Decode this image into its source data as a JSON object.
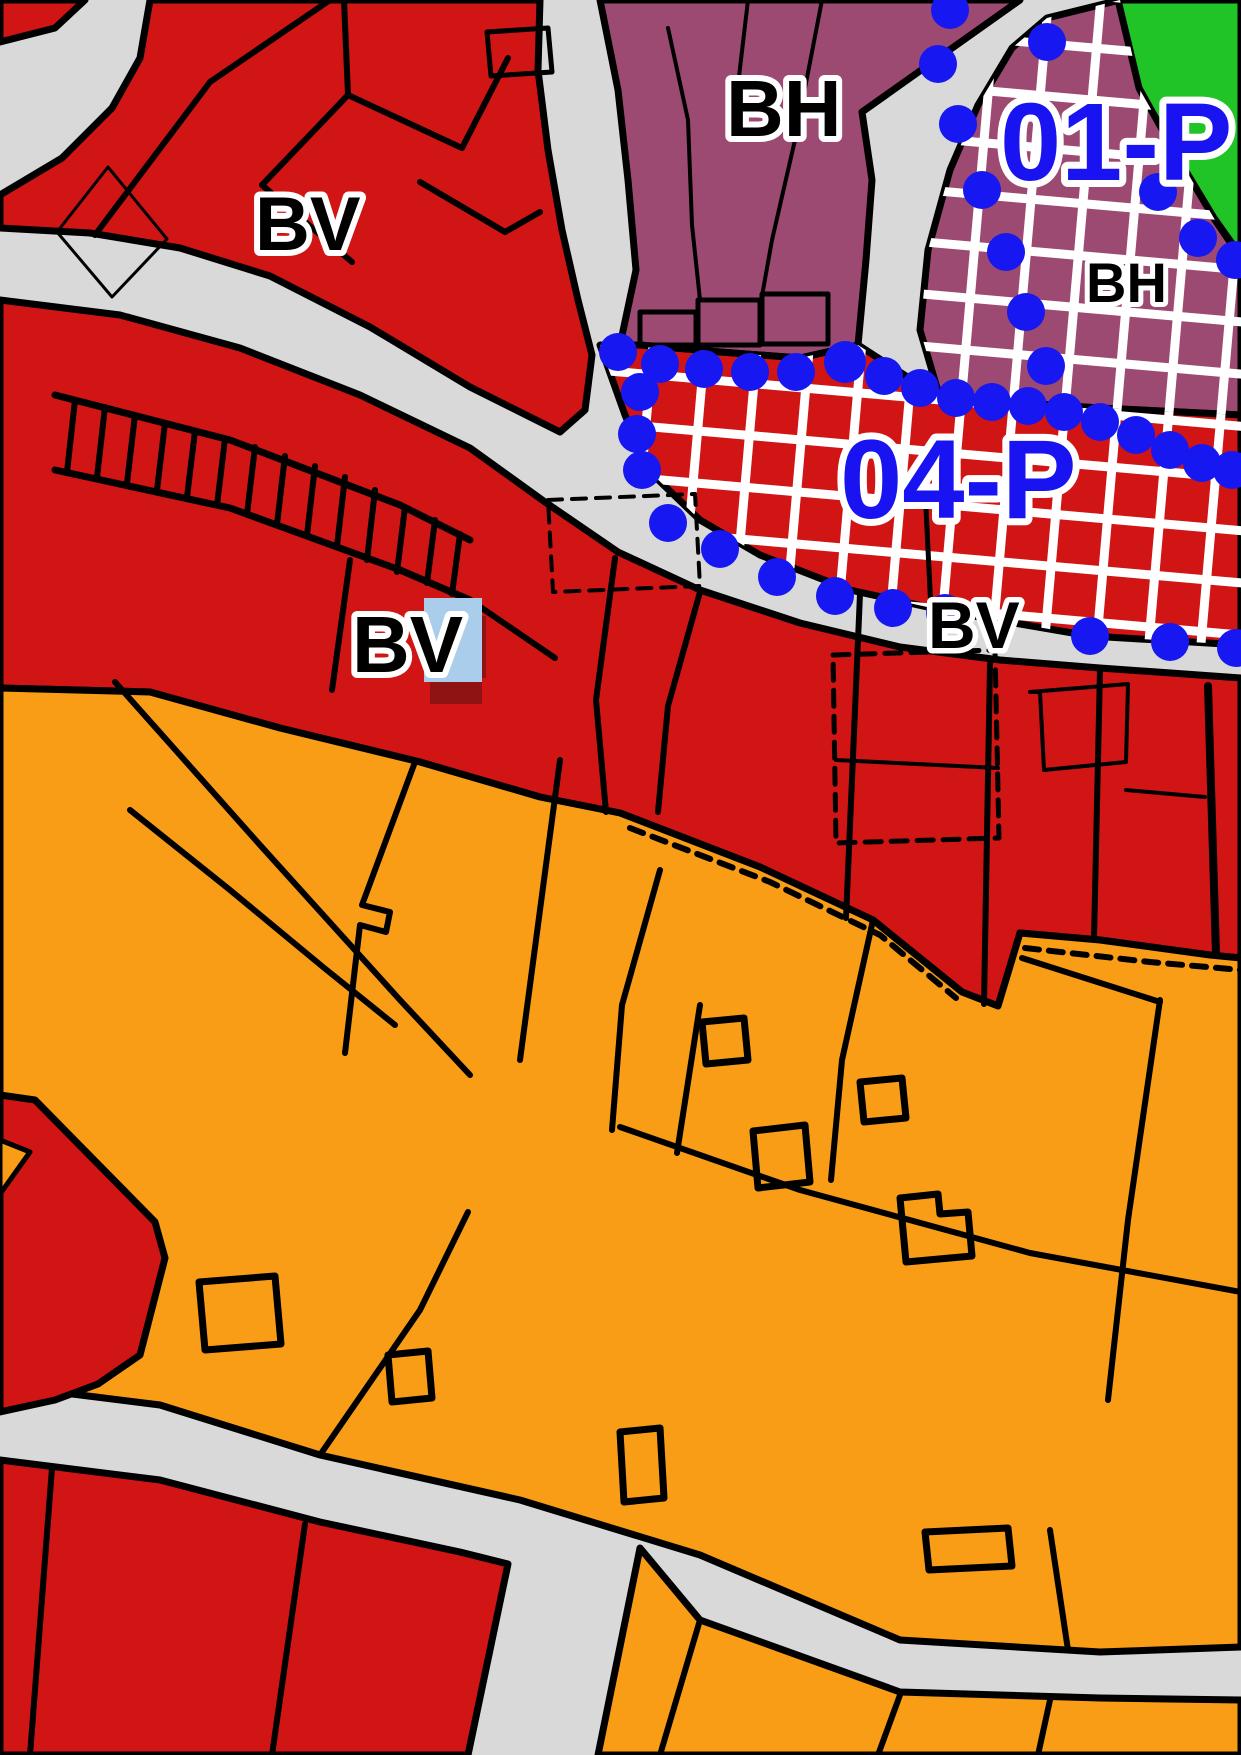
{
  "map": {
    "type": "zoning-plan-map",
    "labels": {
      "bv_top_left": "BV",
      "bh_top": "BH",
      "bh_right": "BH",
      "plan_area_01": "01-P",
      "plan_area_04": "04-P",
      "bv_middle": "BV",
      "bv_right": "BV"
    },
    "palette": {
      "zone_red": "#d11414",
      "zone_orange": "#f99c16",
      "zone_purple": "#9d4a72",
      "zone_green": "#20c427",
      "road_gray": "#d9d9d9",
      "parcel_line": "#000000",
      "plan_boundary_blue": "#1717f2",
      "plan_label_blue": "#1813f0",
      "label_halo": "#ffffff",
      "selected_label_highlight": "#a9cdeb",
      "selected_label_shadow": "#8f1313",
      "overlay_grid": "#ffffff"
    }
  }
}
